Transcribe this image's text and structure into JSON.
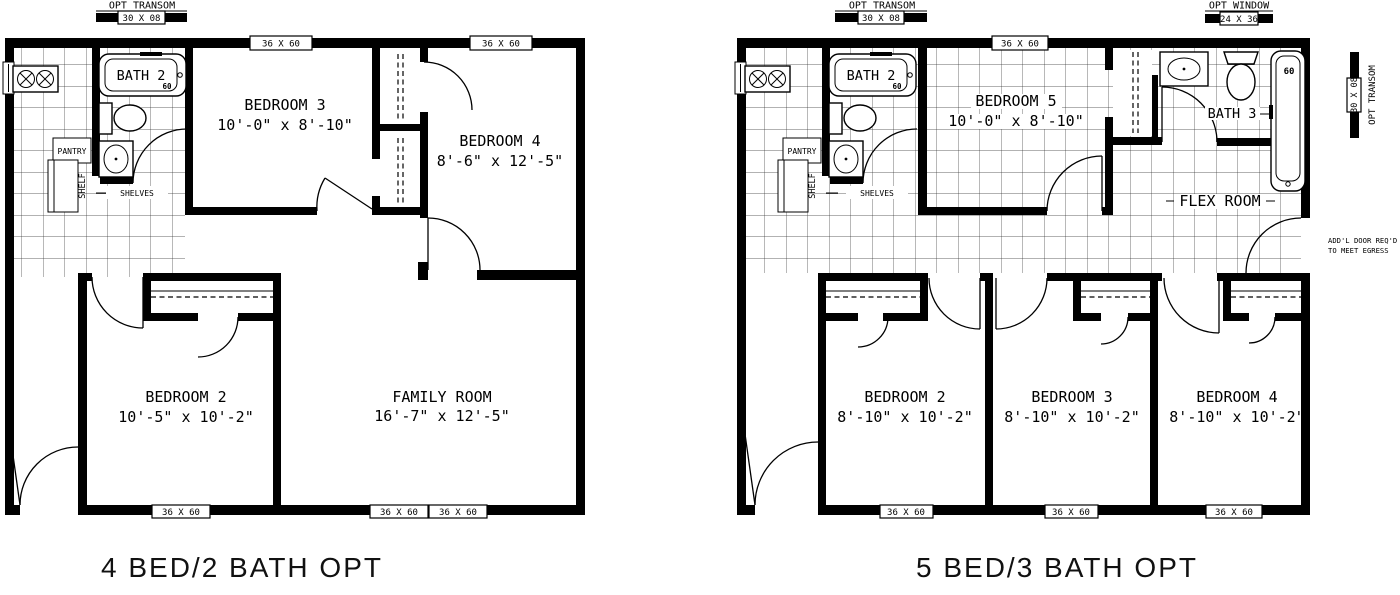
{
  "captions": {
    "left_plan": "4 BED/2 BATH OPT",
    "right_plan": "5 BED/3 BATH OPT"
  },
  "left_plan": {
    "opt_transom": {
      "label": "OPT TRANSOM",
      "size": "30 X 08"
    },
    "window_tags": {
      "top_bedroom3": "36 X 60",
      "top_bedroom4": "36 X 60",
      "bottom_bedroom2": "36 X 60",
      "bottom_family_a": "36 X 60",
      "bottom_family_b": "36 X 60"
    },
    "kitchen": {
      "pantry": "PANTRY",
      "shelf": "SHELF",
      "shelves": "SHELVES"
    },
    "bath2": {
      "name": "BATH 2",
      "tub_size": "60"
    },
    "rooms": {
      "bedroom3": {
        "name": "BEDROOM 3",
        "dims": "10'-0\" x 8'-10\""
      },
      "bedroom4": {
        "name": "BEDROOM 4",
        "dims": "8'-6\" x 12'-5\""
      },
      "bedroom2": {
        "name": "BEDROOM 2",
        "dims": "10'-5\" x 10'-2\""
      },
      "family_room": {
        "name": "FAMILY ROOM",
        "dims": "16'-7\" x 12'-5\""
      }
    }
  },
  "right_plan": {
    "opt_transom": {
      "label": "OPT TRANSOM",
      "size": "30 X 08"
    },
    "opt_window": {
      "label": "OPT WINDOW",
      "size": "24 X 36"
    },
    "side_transom": {
      "label": "OPT TRANSOM",
      "size": "30 X 08"
    },
    "egress_note": {
      "line1": "ADD'L DOOR REQ'D",
      "line2": "TO MEET EGRESS"
    },
    "window_tags": {
      "top_bedroom5": "36 X 60",
      "bottom_bedroom2": "36 X 60",
      "bottom_bedroom3": "36 X 60",
      "bottom_bedroom4": "36 X 60"
    },
    "kitchen": {
      "pantry": "PANTRY",
      "shelf": "SHELF",
      "shelves": "SHELVES"
    },
    "bath2": {
      "name": "BATH 2",
      "tub_size": "60"
    },
    "bath3": {
      "name": "BATH 3",
      "tub_size": "60"
    },
    "rooms": {
      "bedroom5": {
        "name": "BEDROOM 5",
        "dims": "10'-0\" x 8'-10\""
      },
      "flex_room": {
        "name": "FLEX ROOM"
      },
      "bedroom2": {
        "name": "BEDROOM 2",
        "dims": "8'-10\" x 10'-2\""
      },
      "bedroom3": {
        "name": "BEDROOM 3",
        "dims": "8'-10\" x 10'-2\""
      },
      "bedroom4": {
        "name": "BEDROOM 4",
        "dims": "8'-10\" x 10'-2\""
      }
    }
  }
}
